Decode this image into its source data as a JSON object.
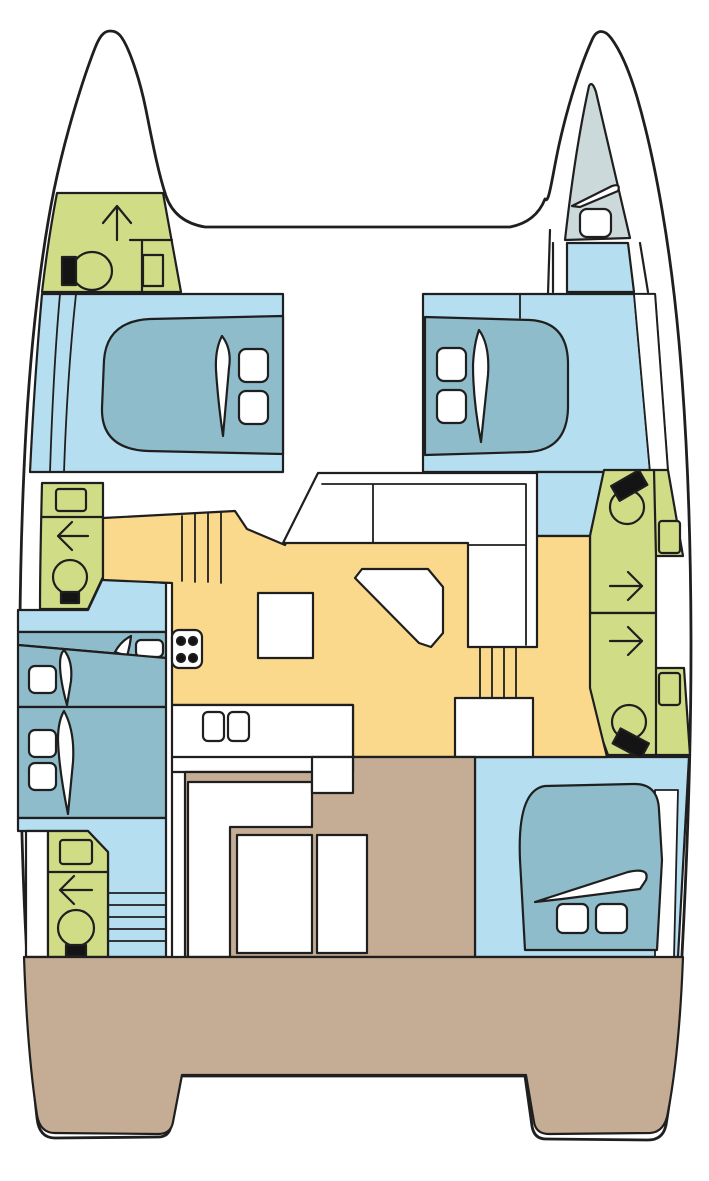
{
  "diagram": {
    "type": "boat-floor-plan",
    "subject": "catamaran-interior-deck-plan",
    "orientation": "bow-up",
    "colors": {
      "outline": "#1f1f1f",
      "deck": "#ffffff",
      "cabin_floor": "#b5dff0",
      "bed": "#8fbccb",
      "wet_room": "#d0dc86",
      "salon_floor": "#fbd98c",
      "cockpit": "#c4ad94",
      "forepeak": "#cbd9db",
      "fixture_dark": "#141414",
      "fixture_white": "#ffffff"
    },
    "areas": {
      "hulls": 2,
      "cabins": [
        "port-forward-double-cabin",
        "starboard-forward-double-cabin",
        "port-aft-single-berth",
        "port-aft-double-berth",
        "starboard-aft-double-cabin",
        "starboard-forepeak-berth"
      ],
      "wet_rooms": [
        "port-bow-head",
        "port-mid-head",
        "port-aft-head",
        "starboard-forward-head",
        "starboard-aft-head"
      ],
      "shared": [
        "salon",
        "galley",
        "foredeck-trampoline",
        "aft-cockpit",
        "swim-platforms"
      ]
    },
    "fixtures": [
      "toilet-icon",
      "sink-icon",
      "shower-arrow-icon",
      "stove-icon",
      "double-sink-icon",
      "bed-pillow-icon",
      "duvet-icon",
      "settee",
      "salon-table",
      "stairs",
      "cockpit-bench",
      "cockpit-table"
    ]
  }
}
